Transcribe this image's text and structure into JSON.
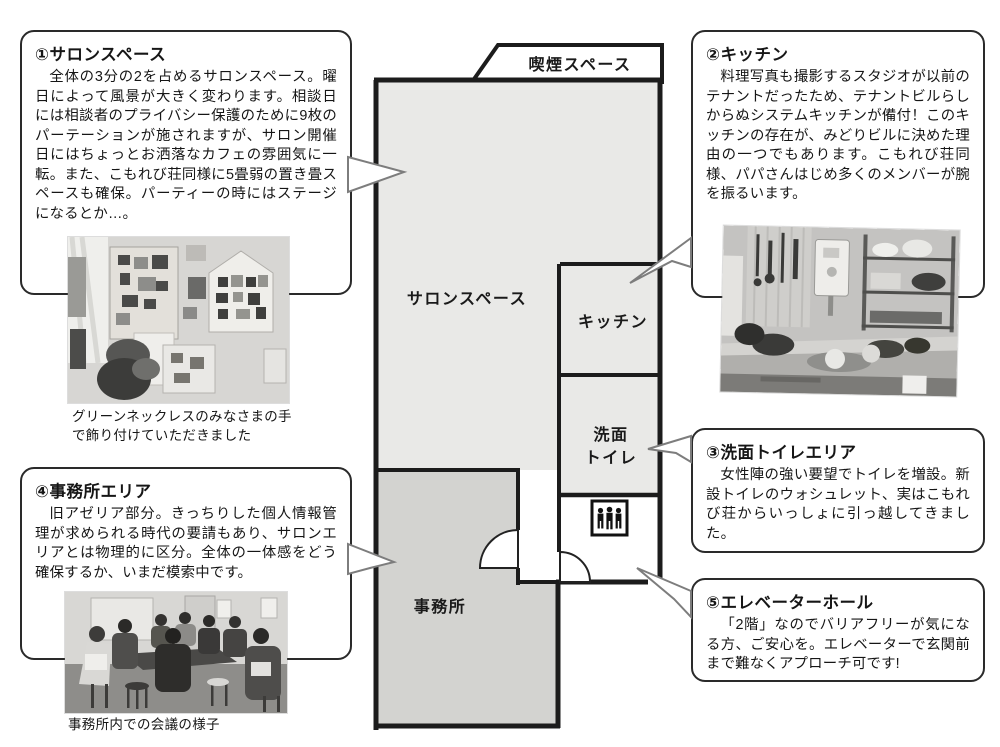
{
  "colors": {
    "salon_fill": "#e9e9e7",
    "office_fill": "#d3d3d0",
    "wall": "#1c1c1c",
    "callout_border": "#2a2a2a",
    "tail_stroke": "#7d7d7d"
  },
  "floorplan": {
    "smoking_label": "喫煙スペース",
    "salon_label": "サロンスペース",
    "kitchen_label": "キッチン",
    "washroom_label_1": "洗面",
    "washroom_label_2": "トイレ",
    "office_label": "事務所",
    "elevator_icon": "elevator-passengers-icon"
  },
  "callouts": [
    {
      "title": "①サロンスペース",
      "body": "全体の3分の2を占めるサロンスペース。曜日によって風景が大きく変わります。相談日には相談者のプライバシー保護のために9枚のパーテーションが施されますが、サロン開催日にはちょっとお洒落なカフェの雰囲気に一転。また、こもれび荘同様に5畳弱の置き畳スペースも確保。パーティーの時にはステージになるとか…。",
      "caption": "グリーンネックレスのみなさまの手で飾り付けていただきました"
    },
    {
      "title": "②キッチン",
      "body": "料理写真も撮影するスタジオが以前のテナントだったため、テナントビルらしからぬシステムキッチンが備付！このキッチンの存在が、みどりビルに決めた理由の一つでもあります。こもれび荘同様、パパさんはじめ多くのメンバーが腕を振るいます。"
    },
    {
      "title": "③洗面トイレエリア",
      "body": "女性陣の強い要望でトイレを増設。新設トイレのウォシュレット、実はこもれび荘からいっしょに引っ越してきました。"
    },
    {
      "title": "④事務所エリア",
      "body": "旧アゼリア部分。きっちりした個人情報管理が求められる時代の要請もあり、サロンエリアとは物理的に区分。全体の一体感をどう確保するか、いまだ模索中です。",
      "caption": "事務所内での会議の様子"
    },
    {
      "title": "⑤エレベーターホール",
      "body": "「2階」なのでバリアフリーが気になる方、ご安心を。エレベーターで玄関前まで難なくアプローチ可です!"
    }
  ]
}
